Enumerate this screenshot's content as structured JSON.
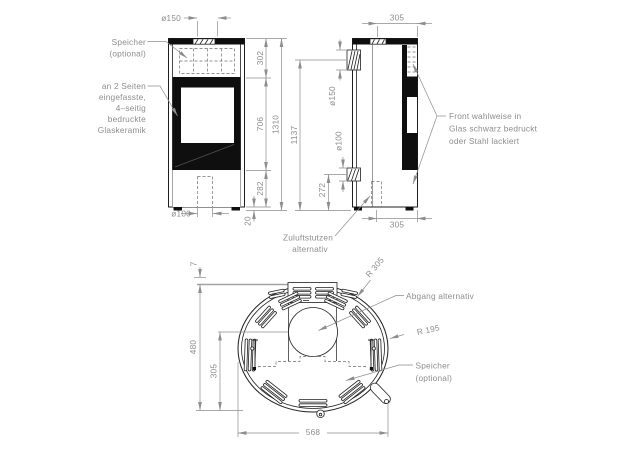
{
  "colors": {
    "line": "#1f1f1f",
    "fill_dark": "#0f0f0f",
    "dimension": "#8d8d8d",
    "label_text": "#8d8d8d",
    "background": "#ffffff"
  },
  "front": {
    "speicher": [
      "Speicher",
      "(optional)"
    ],
    "glass": [
      "an 2 Seiten",
      "eingefasste,",
      "4–seitig",
      "bedruckte",
      "Glaskeramik"
    ],
    "dim_flue": "ø150",
    "dim_air": "ø100",
    "dim_top": "302",
    "dim_mid": "706",
    "dim_base": "282",
    "dim_total": "1310",
    "dim_feet": "20"
  },
  "side": {
    "dim_top_depth": "305",
    "dim_bottom_depth": "305",
    "dim_flue_height": "1137",
    "dim_flue": "ø150",
    "dim_air": "ø100",
    "dim_air_height": "272",
    "front_note": [
      "Front wahlweise in",
      "Glas schwarz bedruckt",
      "oder Stahl lackiert"
    ],
    "zuluft_note": [
      "Zuluftstutzen",
      "alternativ"
    ]
  },
  "top": {
    "dim_collar": "7",
    "dim_depth": "480",
    "dim_rear_depth": "305",
    "dim_width": "568",
    "radius_outer": "R 305",
    "radius_front": "R 195",
    "abgang_note": "Abgang alternativ",
    "speicher_note": [
      "Speicher",
      "(optional)"
    ]
  }
}
